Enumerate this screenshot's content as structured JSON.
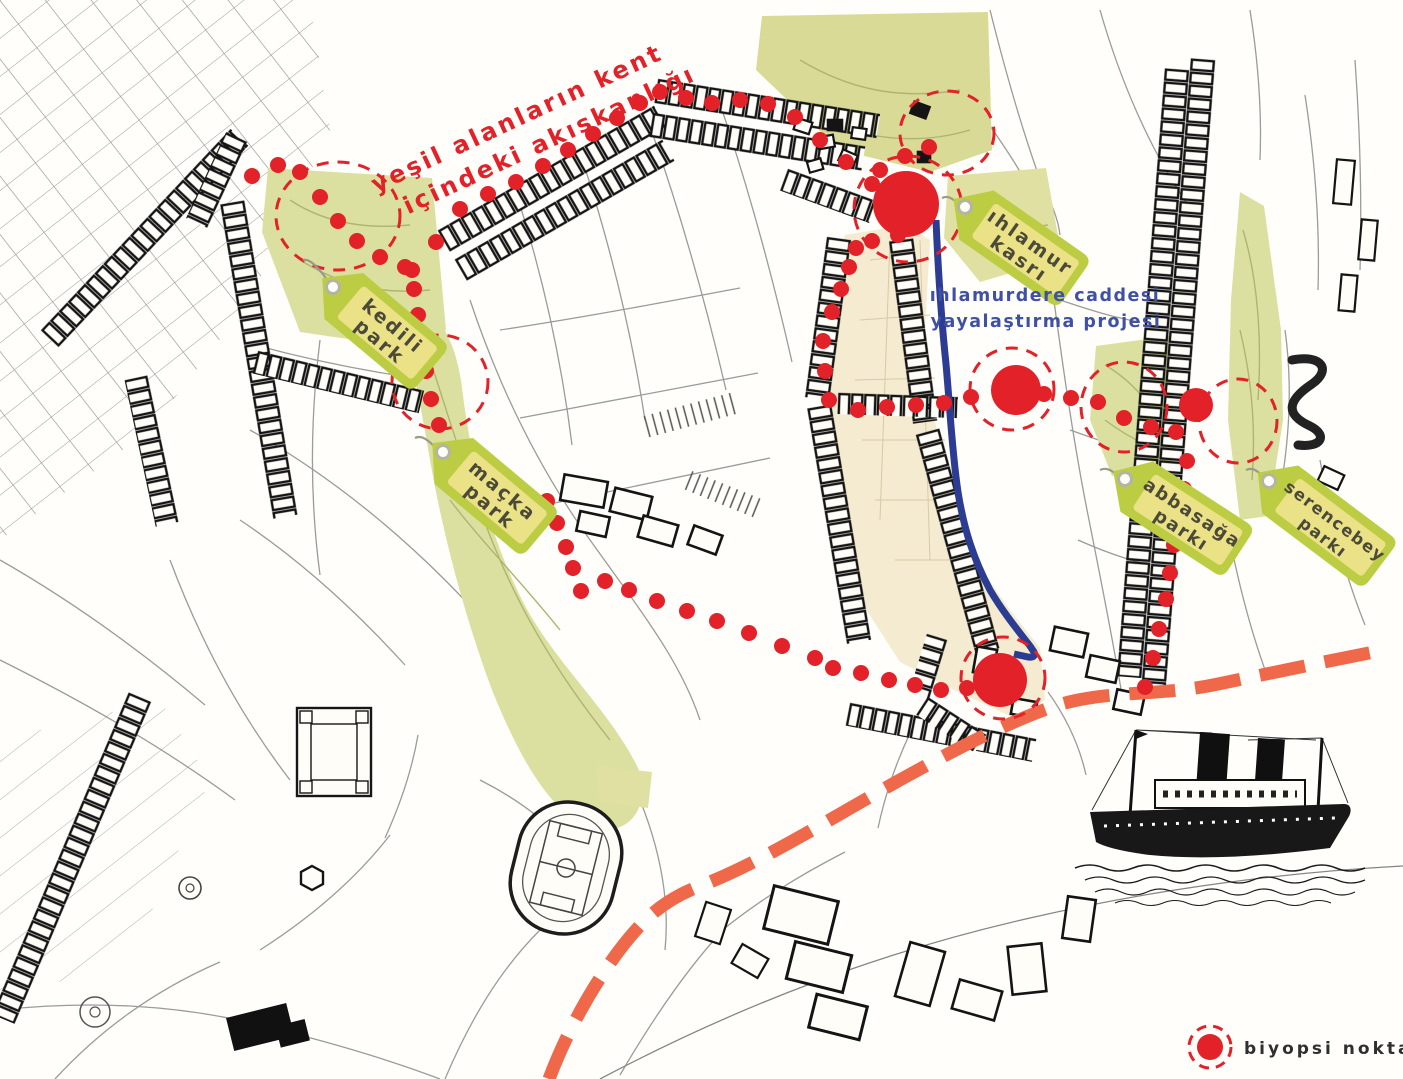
{
  "annotation": {
    "line1": "yeşil alanların kent",
    "line2": "içindeki akışkanlığı"
  },
  "project": {
    "line1": "ıhlamurdere caddesi",
    "line2": "yayalaştırma projesi"
  },
  "legend": {
    "label": "biyopsi noktaları"
  },
  "tags": {
    "kedili": {
      "line1": "kedili",
      "line2": "park"
    },
    "macka": {
      "line1": "maçka",
      "line2": "park"
    },
    "ihlamur": {
      "line1": "ıhlamur",
      "line2": "kasrı"
    },
    "abbasaga": {
      "line1": "abbasağa",
      "line2": "parkı"
    },
    "serencebey": {
      "line1": "serencebey",
      "line2": "parkı"
    }
  },
  "colors": {
    "biopsy_red": "#e22128",
    "route_orange": "#f0684a",
    "street_blue": "#2b3c92",
    "park_green": "#dbe0a0",
    "tag_green": "#bccd44",
    "tag_inner": "#ebe187",
    "valley_beige": "#f4ebd1",
    "project_text_blue": "#3f51a4",
    "ink": "#141414"
  },
  "map": {
    "dot_radius": 8,
    "dot_chains": [
      [
        [
          412,
          270
        ],
        [
          436,
          242
        ],
        [
          460,
          209
        ],
        [
          488,
          194
        ],
        [
          516,
          182
        ],
        [
          543,
          166
        ],
        [
          568,
          150
        ],
        [
          593,
          134
        ],
        [
          617,
          118
        ],
        [
          640,
          103
        ],
        [
          660,
          92
        ],
        [
          686,
          98
        ],
        [
          712,
          103
        ],
        [
          740,
          100
        ],
        [
          768,
          104
        ],
        [
          795,
          117
        ],
        [
          820,
          140
        ],
        [
          846,
          162
        ],
        [
          872,
          184
        ]
      ],
      [
        [
          252,
          176
        ],
        [
          278,
          165
        ],
        [
          300,
          172
        ],
        [
          320,
          197
        ],
        [
          338,
          221
        ],
        [
          357,
          241
        ],
        [
          380,
          257
        ],
        [
          405,
          267
        ],
        [
          414,
          289
        ],
        [
          418,
          315
        ],
        [
          423,
          343
        ],
        [
          426,
          371
        ],
        [
          431,
          399
        ],
        [
          439,
          425
        ],
        [
          450,
          450
        ],
        [
          463,
          471
        ],
        [
          489,
          486
        ],
        [
          517,
          495
        ],
        [
          547,
          501
        ],
        [
          557,
          523
        ],
        [
          566,
          547
        ],
        [
          573,
          568
        ],
        [
          581,
          591
        ],
        [
          605,
          581
        ],
        [
          629,
          590
        ],
        [
          657,
          601
        ],
        [
          687,
          611
        ],
        [
          717,
          621
        ],
        [
          749,
          633
        ],
        [
          782,
          646
        ],
        [
          815,
          658
        ],
        [
          833,
          668
        ],
        [
          861,
          673
        ],
        [
          889,
          680
        ],
        [
          915,
          685
        ],
        [
          941,
          690
        ],
        [
          967,
          688
        ]
      ],
      [
        [
          898,
          235
        ],
        [
          872,
          241
        ],
        [
          856,
          248
        ],
        [
          849,
          267
        ],
        [
          841,
          289
        ],
        [
          832,
          312
        ],
        [
          823,
          341
        ],
        [
          825,
          371
        ],
        [
          829,
          400
        ],
        [
          858,
          410
        ],
        [
          887,
          407
        ],
        [
          916,
          405
        ],
        [
          944,
          403
        ],
        [
          971,
          397
        ]
      ],
      [
        [
          1044,
          394
        ],
        [
          1071,
          398
        ],
        [
          1098,
          402
        ],
        [
          1124,
          418
        ],
        [
          1151,
          427
        ],
        [
          1176,
          432
        ]
      ],
      [
        [
          1187,
          461
        ],
        [
          1184,
          489
        ],
        [
          1179,
          517
        ],
        [
          1174,
          545
        ],
        [
          1170,
          573
        ],
        [
          1166,
          599
        ],
        [
          1159,
          629
        ],
        [
          1153,
          658
        ],
        [
          1145,
          687
        ]
      ],
      [
        [
          880,
          170
        ],
        [
          905,
          156
        ],
        [
          929,
          147
        ]
      ]
    ],
    "dashed_circles": [
      {
        "x": 338,
        "y": 216,
        "rx": 62,
        "ry": 54
      },
      {
        "x": 440,
        "y": 382,
        "rx": 48,
        "ry": 47
      },
      {
        "x": 947,
        "y": 133,
        "rx": 47,
        "ry": 42
      },
      {
        "x": 908,
        "y": 209,
        "rx": 54,
        "ry": 53
      },
      {
        "x": 1012,
        "y": 389,
        "rx": 42,
        "ry": 41
      },
      {
        "x": 1124,
        "y": 407,
        "rx": 43,
        "ry": 45
      },
      {
        "x": 1238,
        "y": 421,
        "rx": 39,
        "ry": 42
      },
      {
        "x": 1003,
        "y": 678,
        "rx": 42,
        "ry": 41
      }
    ],
    "biopsy_points": [
      {
        "x": 906,
        "y": 204,
        "r": 33
      },
      {
        "x": 1016,
        "y": 390,
        "r": 25
      },
      {
        "x": 1196,
        "y": 405,
        "r": 17
      },
      {
        "x": 1000,
        "y": 680,
        "r": 27
      }
    ]
  }
}
